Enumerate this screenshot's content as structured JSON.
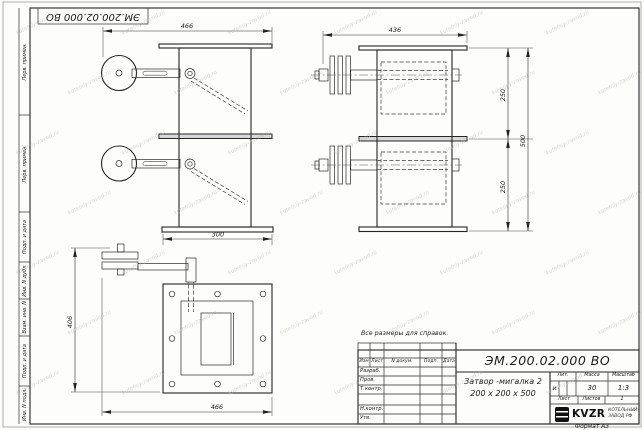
{
  "sheet": {
    "corner_designation": "ЭМ.200.02.000 ВО",
    "note": "Все размеры для справок.",
    "format_label": "Формат А3",
    "watermark": "kotelniy-zavod.ru"
  },
  "margin": {
    "first_use_1": "Перв. примен.",
    "first_use_2": "Перв. примен.",
    "sign_date_1": "Подп. и дата",
    "inv_dupl": "Инв. N дубл.",
    "repl_inv": "Взам. инв. N",
    "sign_date_2": "Подп. и дата",
    "inv_orig": "Инв. N подл."
  },
  "views": {
    "front": {
      "dim_overall_width": "466",
      "dim_flange_width": "300"
    },
    "side": {
      "dim_overall_width": "436",
      "dim_upper_height": "250",
      "dim_lower_height": "250",
      "dim_total_height": "500"
    },
    "plan": {
      "dim_left_height": "406",
      "dim_bottom_width": "466"
    }
  },
  "title_block": {
    "designation": "ЭМ.200.02.000 ВО",
    "name_line1": "Затвор -мигалка 2",
    "name_line2": "200 х 200 х 500",
    "change_table": {
      "izm": "Изм",
      "list": "Лист",
      "doc": "N докум.",
      "sign": "Подп.",
      "date": "Дата"
    },
    "roles": {
      "developed": "Разраб.",
      "checked": "Пров.",
      "t_control": "Т.контр.",
      "n_control": "Н.контр.",
      "approved": "Утв."
    },
    "lit_label": "Лит.",
    "mass_label": "Масса",
    "scale_label": "Масштаб",
    "lit_value": "и",
    "mass_value": "30",
    "scale_value": "1:3",
    "sheet_label": "Лист",
    "sheets_label": "Листов",
    "sheets_value": "1",
    "logo_text": "KVZR",
    "logo_sub1": "КОТЕЛЬНЫЙ",
    "logo_sub2": "ЗАВОД РФ"
  }
}
